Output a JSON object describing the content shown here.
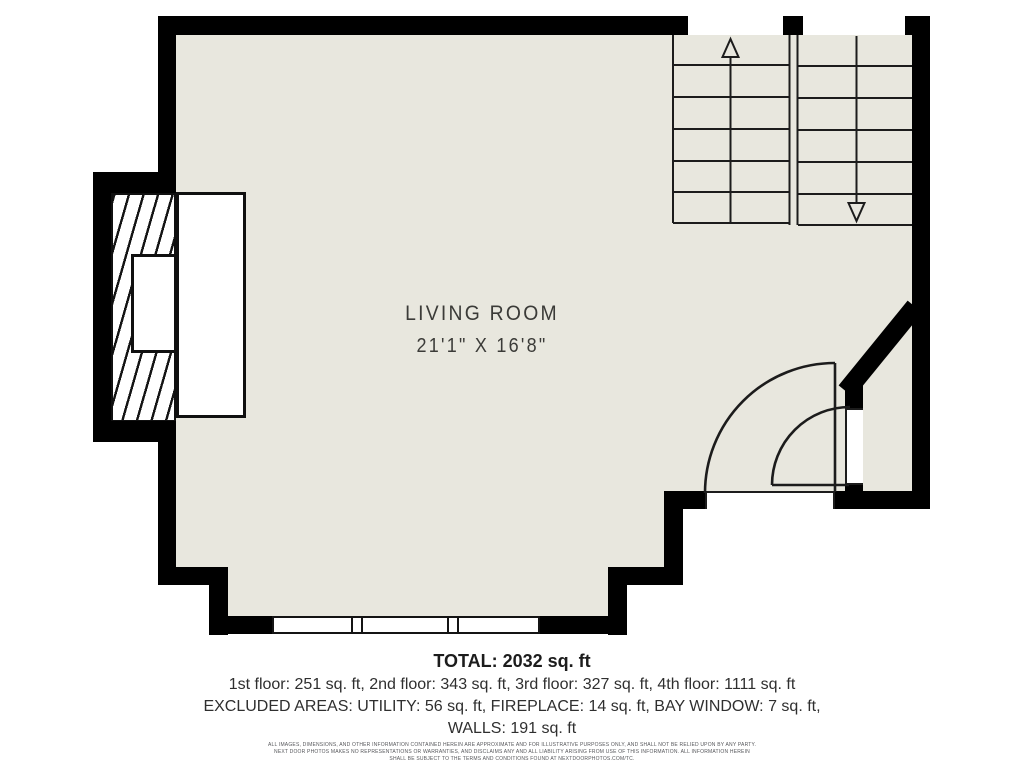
{
  "floorplan": {
    "room": {
      "name": "LIVING ROOM",
      "dimensions": "21'1\" X 16'8\""
    }
  },
  "summary": {
    "total": "TOTAL: 2032 sq. ft",
    "floors": "1st floor: 251 sq. ft, 2nd floor: 343 sq. ft, 3rd floor: 327 sq. ft, 4th floor: 1111 sq. ft",
    "excluded": "EXCLUDED AREAS: UTILITY: 56 sq. ft, FIREPLACE: 14 sq. ft, BAY WINDOW: 7 sq. ft,",
    "walls": "WALLS: 191 sq. ft"
  },
  "disclaimer": {
    "line1": "ALL IMAGES, DIMENSIONS, AND OTHER INFORMATION CONTAINED HEREIN ARE APPROXIMATE AND FOR ILLUSTRATIVE PURPOSES ONLY, AND SHALL NOT BE RELIED UPON BY ANY PARTY.",
    "line2": "NEXT DOOR PHOTOS MAKES NO REPRESENTATIONS OR WARRANTIES, AND DISCLAIMS ANY AND ALL LIABILITY ARISING FROM USE OF THIS INFORMATION. ALL INFORMATION HEREIN",
    "line3": "SHALL BE SUBJECT TO THE TERMS AND CONDITIONS FOUND AT NEXTDOORPHOTOS.COM/TC."
  },
  "colors": {
    "floor": "#e8e7de",
    "wall": "#000000",
    "line": "#1c1c1c",
    "text": "#2f2f2f",
    "label": "#3b3b38",
    "disclaimer": "#56575b"
  }
}
